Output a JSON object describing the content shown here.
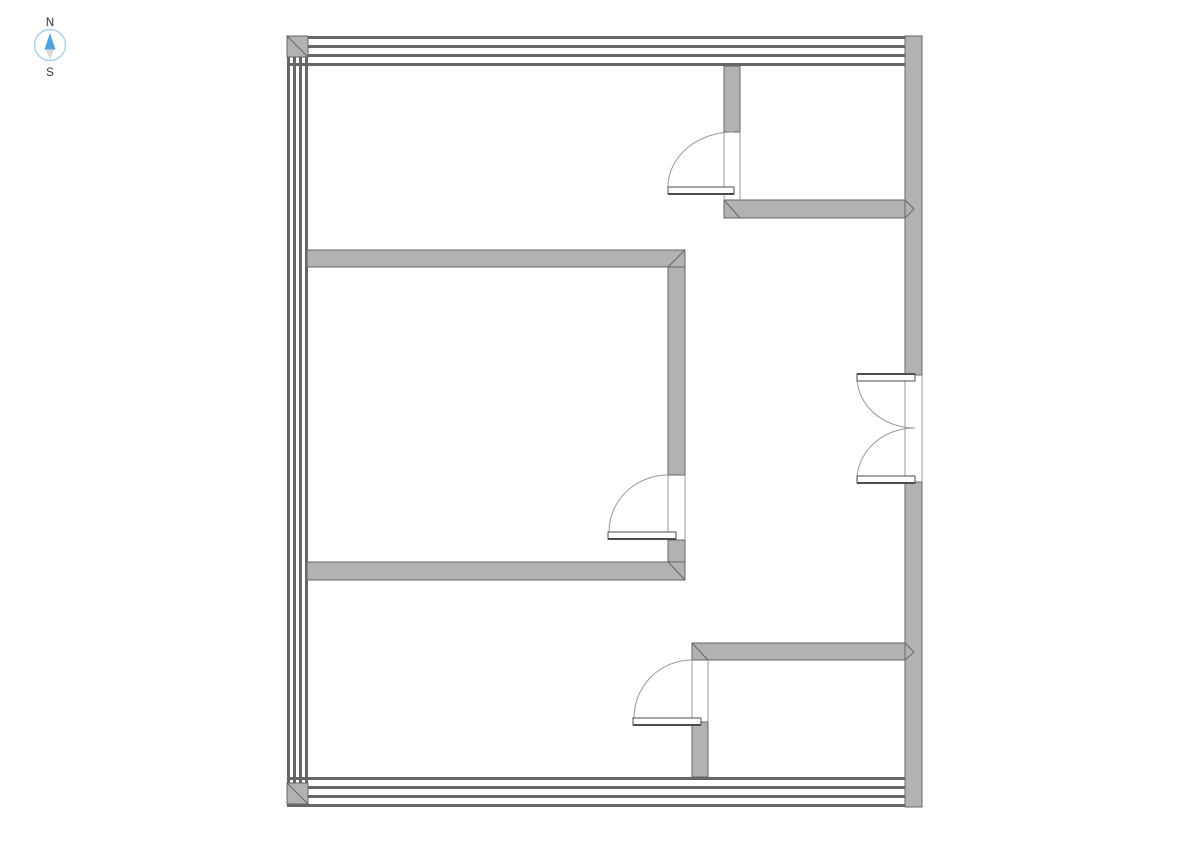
{
  "compass": {
    "north_label": "N",
    "south_label": "S"
  },
  "colors": {
    "background": "#ffffff",
    "wall_fill": "#b2b2b2",
    "wall_stroke": "#666666",
    "stripe": "#666666",
    "jamb": "#9a9a9a",
    "arc": "#999999",
    "leaf_fill": "#ffffff",
    "leaf_stroke": "#4d4d4d",
    "compass_ring": "#aacfe8",
    "needle_north": "#4da3dc",
    "needle_south": "#d9d9d9",
    "label": "#333333"
  },
  "floorplan": {
    "striped_walls": [
      {
        "name": "outer-wall-top",
        "dir": "h",
        "from": 287,
        "to": 922,
        "lines": [
          36,
          45,
          54,
          63
        ],
        "thickness": 3
      },
      {
        "name": "outer-wall-bottom",
        "dir": "h",
        "from": 287,
        "to": 922,
        "lines": [
          777,
          786,
          795,
          804
        ],
        "thickness": 3
      },
      {
        "name": "outer-wall-left",
        "dir": "v",
        "from": 36,
        "to": 807,
        "lines": [
          287,
          293,
          299,
          305
        ],
        "thickness": 3
      }
    ],
    "corner_blocks": [
      {
        "name": "corner-top-left",
        "x": 287,
        "y": 36,
        "w": 21,
        "h": 21,
        "diag": [
          287,
          36,
          308,
          57
        ]
      },
      {
        "name": "corner-top-right",
        "x": 905,
        "y": 36,
        "w": 17,
        "h": 17,
        "diag": [
          905,
          53,
          922,
          36
        ]
      },
      {
        "name": "corner-bottom-left",
        "x": 287,
        "y": 783,
        "w": 21,
        "h": 21,
        "diag": [
          287,
          783,
          308,
          804
        ]
      },
      {
        "name": "corner-bottom-right",
        "x": 905,
        "y": 786,
        "w": 17,
        "h": 21,
        "diag": [
          905,
          786,
          922,
          807
        ]
      }
    ],
    "solid_walls": [
      {
        "name": "outer-wall-right-upper",
        "x": 905,
        "y": 36,
        "w": 17,
        "h": 339
      },
      {
        "name": "outer-wall-right-lower",
        "x": 905,
        "y": 482,
        "w": 17,
        "h": 325
      },
      {
        "name": "closet-wall-vertical",
        "x": 724,
        "y": 66,
        "w": 16,
        "h": 66
      },
      {
        "name": "closet-wall-horizontal",
        "x": 724,
        "y": 200,
        "w": 181,
        "h": 18
      },
      {
        "name": "room-wall-top",
        "x": 307,
        "y": 250,
        "w": 378,
        "h": 17
      },
      {
        "name": "room-wall-right-upper",
        "x": 668,
        "y": 267,
        "w": 17,
        "h": 208
      },
      {
        "name": "room-wall-right-lower",
        "x": 668,
        "y": 540,
        "w": 17,
        "h": 22
      },
      {
        "name": "room-wall-bottom",
        "x": 307,
        "y": 562,
        "w": 378,
        "h": 18
      },
      {
        "name": "lower-wall-horizontal",
        "x": 692,
        "y": 643,
        "w": 213,
        "h": 17
      },
      {
        "name": "lower-wall-vertical",
        "x": 692,
        "y": 722,
        "w": 16,
        "h": 55
      }
    ],
    "miter_lines": [
      {
        "name": "miter-room-top-right",
        "x1": 685,
        "y1": 250,
        "x2": 668,
        "y2": 267
      },
      {
        "name": "miter-room-bottom-right",
        "x1": 668,
        "y1": 562,
        "x2": 685,
        "y2": 580
      },
      {
        "name": "miter-closet-corner",
        "x1": 724,
        "y1": 200,
        "x2": 740,
        "y2": 218
      },
      {
        "name": "miter-lower-corner",
        "x1": 692,
        "y1": 643,
        "x2": 708,
        "y2": 660
      },
      {
        "name": "miter-t-joint-upper-a",
        "x1": 905,
        "y1": 200,
        "x2": 914,
        "y2": 209
      },
      {
        "name": "miter-t-joint-upper-b",
        "x1": 905,
        "y1": 218,
        "x2": 914,
        "y2": 209
      },
      {
        "name": "miter-t-joint-lower-a",
        "x1": 905,
        "y1": 643,
        "x2": 914,
        "y2": 652
      },
      {
        "name": "miter-t-joint-lower-b",
        "x1": 905,
        "y1": 660,
        "x2": 914,
        "y2": 652
      }
    ],
    "jamb_lines": [
      {
        "name": "jamb-closet-left",
        "x1": 724,
        "y1": 132,
        "x2": 724,
        "y2": 200
      },
      {
        "name": "jamb-closet-right",
        "x1": 740,
        "y1": 132,
        "x2": 740,
        "y2": 200
      },
      {
        "name": "jamb-bedroom-inner",
        "x1": 668,
        "y1": 475,
        "x2": 668,
        "y2": 540
      },
      {
        "name": "jamb-bedroom-outer",
        "x1": 685,
        "y1": 475,
        "x2": 685,
        "y2": 540
      },
      {
        "name": "jamb-lower-left",
        "x1": 692,
        "y1": 660,
        "x2": 692,
        "y2": 722
      },
      {
        "name": "jamb-lower-right",
        "x1": 708,
        "y1": 660,
        "x2": 708,
        "y2": 722
      },
      {
        "name": "jamb-entry-inner",
        "x1": 905,
        "y1": 375,
        "x2": 905,
        "y2": 482
      },
      {
        "name": "jamb-entry-outer",
        "x1": 922,
        "y1": 375,
        "x2": 922,
        "y2": 482
      }
    ],
    "doors": [
      {
        "name": "closet-door",
        "leaf": {
          "x": 668,
          "y": 187,
          "w": 66,
          "h": 7
        },
        "thick_edge": {
          "x1": 668,
          "y1": 194,
          "x2": 734,
          "y2": 194
        },
        "arc": {
          "x1": 668,
          "y1": 187,
          "x2": 733,
          "y2": 132,
          "rx": 65,
          "ry": 55,
          "sweep": 1
        }
      },
      {
        "name": "bedroom-door",
        "leaf": {
          "x": 608,
          "y": 532,
          "w": 68,
          "h": 7
        },
        "thick_edge": {
          "x1": 608,
          "y1": 539,
          "x2": 676,
          "y2": 539
        },
        "arc": {
          "x1": 609,
          "y1": 532,
          "x2": 668,
          "y2": 475,
          "rx": 59,
          "ry": 57,
          "sweep": 1
        }
      },
      {
        "name": "lower-door",
        "leaf": {
          "x": 633,
          "y": 718,
          "w": 68,
          "h": 7
        },
        "thick_edge": {
          "x1": 633,
          "y1": 725,
          "x2": 701,
          "y2": 725
        },
        "arc": {
          "x1": 634,
          "y1": 718,
          "x2": 692,
          "y2": 660,
          "rx": 58,
          "ry": 58,
          "sweep": 1
        }
      },
      {
        "name": "entry-double-door-top",
        "leaf": {
          "x": 857,
          "y": 374,
          "w": 58,
          "h": 7
        },
        "thick_edge": {
          "x1": 857,
          "y1": 374,
          "x2": 915,
          "y2": 374
        },
        "arc": {
          "x1": 857,
          "y1": 377,
          "x2": 915,
          "y2": 428,
          "rx": 58,
          "ry": 51,
          "sweep": 0
        }
      },
      {
        "name": "entry-double-door-bottom",
        "leaf": {
          "x": 857,
          "y": 476,
          "w": 58,
          "h": 7
        },
        "thick_edge": {
          "x1": 857,
          "y1": 483,
          "x2": 915,
          "y2": 483
        },
        "arc": {
          "x1": 857,
          "y1": 480,
          "x2": 915,
          "y2": 428,
          "rx": 58,
          "ry": 52,
          "sweep": 1
        }
      }
    ]
  }
}
